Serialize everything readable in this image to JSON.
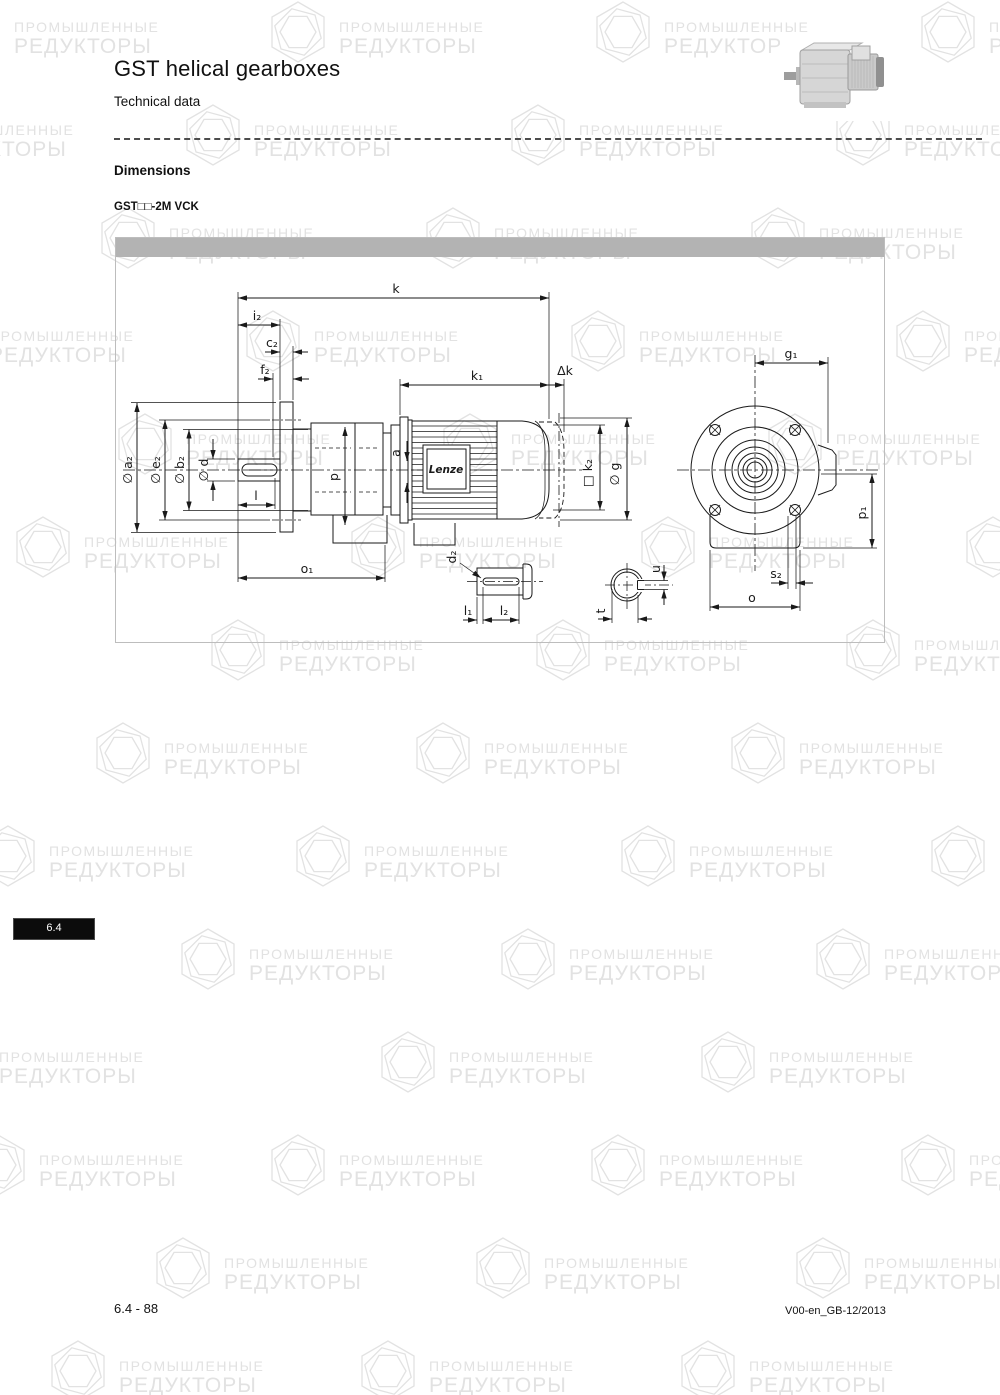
{
  "header": {
    "title": "GST helical gearboxes",
    "subtitle": "Technical data"
  },
  "section": {
    "heading": "Dimensions",
    "model": "GST□□-2M VCK"
  },
  "sidetab": {
    "label": "6.4"
  },
  "footer": {
    "left": "6.4 - 88",
    "right": "V00-en_GB-12/2013"
  },
  "drawing": {
    "brand": "Lenze",
    "labels": {
      "k": "k",
      "k1": "k₁",
      "dk": "Δk",
      "i2": "i₂",
      "c2": "c₂",
      "f2": "f₂",
      "da2": "∅ a₂",
      "de2": "∅ e₂",
      "db2": "∅ b₂",
      "dd": "∅ d",
      "l": "l",
      "p": "p",
      "a": "a",
      "o1": "o₁",
      "k2": "□ k₂",
      "dg": "∅ g",
      "g1": "g₁",
      "p1": "p₁",
      "s2": "s₂",
      "o": "o",
      "d2": "d₂",
      "l1": "l₁",
      "l2": "l₂",
      "t": "t",
      "u": "u"
    }
  },
  "watermark": {
    "line1": "ПРОМЫШЛЕННЫЕ",
    "line2": "РЕДУКТОРЫ",
    "color": "#e2e2e2",
    "positions": [
      [
        -60,
        0
      ],
      [
        265,
        0
      ],
      [
        590,
        0
      ],
      [
        915,
        0
      ],
      [
        -145,
        103
      ],
      [
        180,
        103
      ],
      [
        505,
        103
      ],
      [
        830,
        103
      ],
      [
        95,
        206
      ],
      [
        420,
        206
      ],
      [
        745,
        206
      ],
      [
        -85,
        309
      ],
      [
        240,
        309
      ],
      [
        565,
        309
      ],
      [
        890,
        309
      ],
      [
        112,
        412
      ],
      [
        437,
        412
      ],
      [
        762,
        412
      ],
      [
        10,
        515
      ],
      [
        345,
        515
      ],
      [
        635,
        515
      ],
      [
        960,
        515
      ],
      [
        205,
        618
      ],
      [
        530,
        618
      ],
      [
        840,
        618
      ],
      [
        90,
        721
      ],
      [
        410,
        721
      ],
      [
        725,
        721
      ],
      [
        -25,
        824
      ],
      [
        290,
        824
      ],
      [
        615,
        824
      ],
      [
        925,
        824
      ],
      [
        175,
        927
      ],
      [
        495,
        927
      ],
      [
        810,
        927
      ],
      [
        -75,
        1030
      ],
      [
        375,
        1030
      ],
      [
        695,
        1030
      ],
      [
        -35,
        1133
      ],
      [
        265,
        1133
      ],
      [
        585,
        1133
      ],
      [
        895,
        1133
      ],
      [
        150,
        1236
      ],
      [
        470,
        1236
      ],
      [
        790,
        1236
      ],
      [
        45,
        1339
      ],
      [
        355,
        1339
      ],
      [
        675,
        1339
      ],
      [
        995,
        1339
      ]
    ]
  },
  "colors": {
    "bar": "#b3b3b3",
    "line": "#1a1a1a",
    "frame_border": "#bdbdbd"
  }
}
